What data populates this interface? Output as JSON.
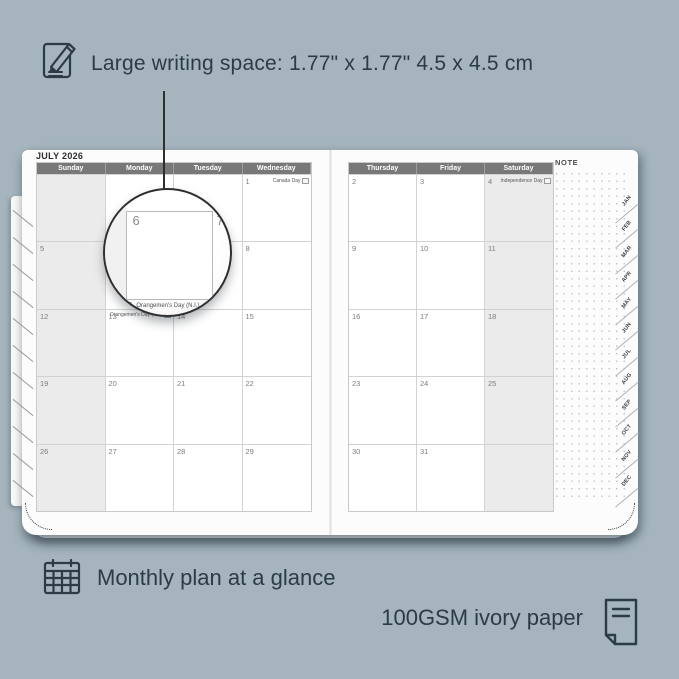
{
  "colors": {
    "background": "#a5b4bd",
    "ink": "#2c3b45",
    "page": "#fcfcfc",
    "header_bar": "#787878",
    "weekend_fill": "#ebebeb",
    "grid_line": "#d2d2d2",
    "day_number": "#7d7d7d"
  },
  "annotations": {
    "top": {
      "icon": "pencil-note-icon",
      "text": "Large writing space: 1.77\" x 1.77\" 4.5 x 4.5 cm"
    },
    "bottom_left": {
      "icon": "calendar-grid-icon",
      "text": "Monthly plan at a glance"
    },
    "bottom_right": {
      "icon": "paper-icon",
      "text": "100GSM ivory paper"
    }
  },
  "planner": {
    "month_title": "JULY 2026",
    "note_label": "NOTE",
    "month_tabs": [
      "JAN",
      "FEB",
      "MAR",
      "APR",
      "MAY",
      "JUN",
      "JUL",
      "AUG",
      "SEP",
      "OCT",
      "NOV",
      "DEC"
    ],
    "left_page": {
      "headers": [
        "Sunday",
        "Monday",
        "Tuesday",
        "Wednesday"
      ],
      "rows": [
        [
          {
            "day": ""
          },
          {
            "day": ""
          },
          {
            "day": ""
          },
          {
            "day": "1",
            "holiday": "Canada Day"
          }
        ],
        [
          {
            "day": "5"
          },
          {
            "day": "6"
          },
          {
            "day": "7"
          },
          {
            "day": "8"
          }
        ],
        [
          {
            "day": "12"
          },
          {
            "day": "13",
            "holiday": "Orangemen's Day (N.I.)"
          },
          {
            "day": "14"
          },
          {
            "day": "15"
          }
        ],
        [
          {
            "day": "19"
          },
          {
            "day": "20"
          },
          {
            "day": "21"
          },
          {
            "day": "22"
          }
        ],
        [
          {
            "day": "26"
          },
          {
            "day": "27"
          },
          {
            "day": "28"
          },
          {
            "day": "29"
          }
        ]
      ]
    },
    "right_page": {
      "headers": [
        "Thursday",
        "Friday",
        "Saturday"
      ],
      "rows": [
        [
          {
            "day": "2"
          },
          {
            "day": "3"
          },
          {
            "day": "4",
            "holiday": "Independence Day"
          }
        ],
        [
          {
            "day": "9"
          },
          {
            "day": "10"
          },
          {
            "day": "11"
          }
        ],
        [
          {
            "day": "16"
          },
          {
            "day": "17"
          },
          {
            "day": "18"
          }
        ],
        [
          {
            "day": "23"
          },
          {
            "day": "24"
          },
          {
            "day": "25"
          }
        ],
        [
          {
            "day": "30"
          },
          {
            "day": "31"
          },
          {
            "day": ""
          }
        ]
      ]
    }
  },
  "magnifier": {
    "day_main": "6",
    "day_next": "7",
    "peek_day": "13",
    "peek_text": "Orangemen's Day (N.I.)"
  }
}
